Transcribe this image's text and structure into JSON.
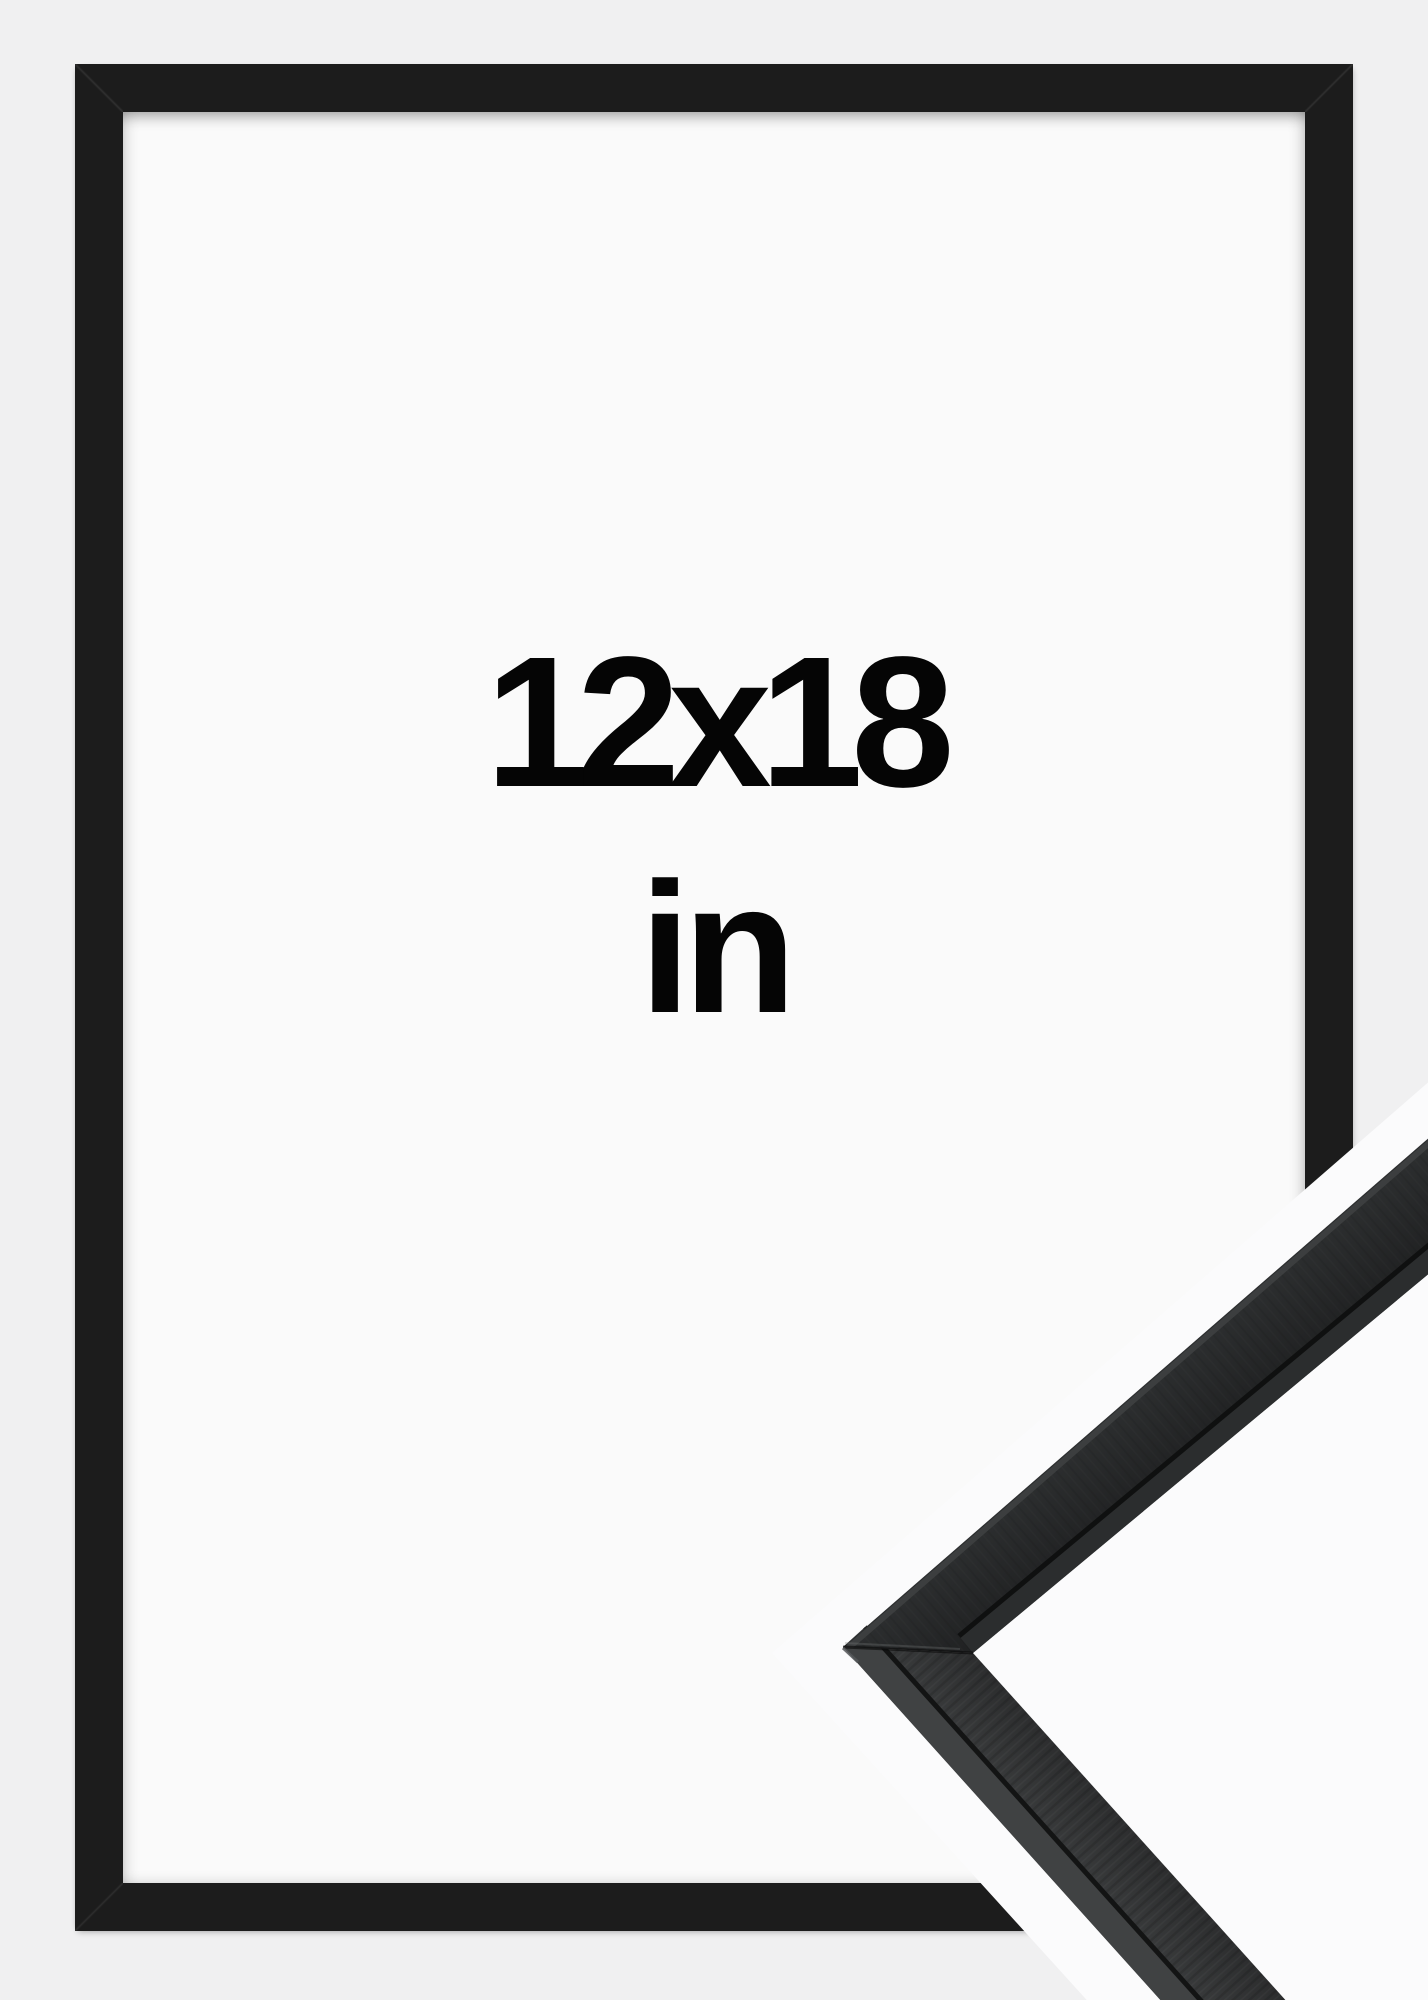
{
  "size_label": {
    "dimensions": "12x18",
    "unit": "in"
  },
  "colors": {
    "background": "#f0f0f1",
    "mat": "#fafafa",
    "frame": "#1c1c1c",
    "text": "#050505",
    "detail_bg": "#fbfbfc",
    "molding_dark": "#212223",
    "molding_light": "#3d3f40"
  }
}
